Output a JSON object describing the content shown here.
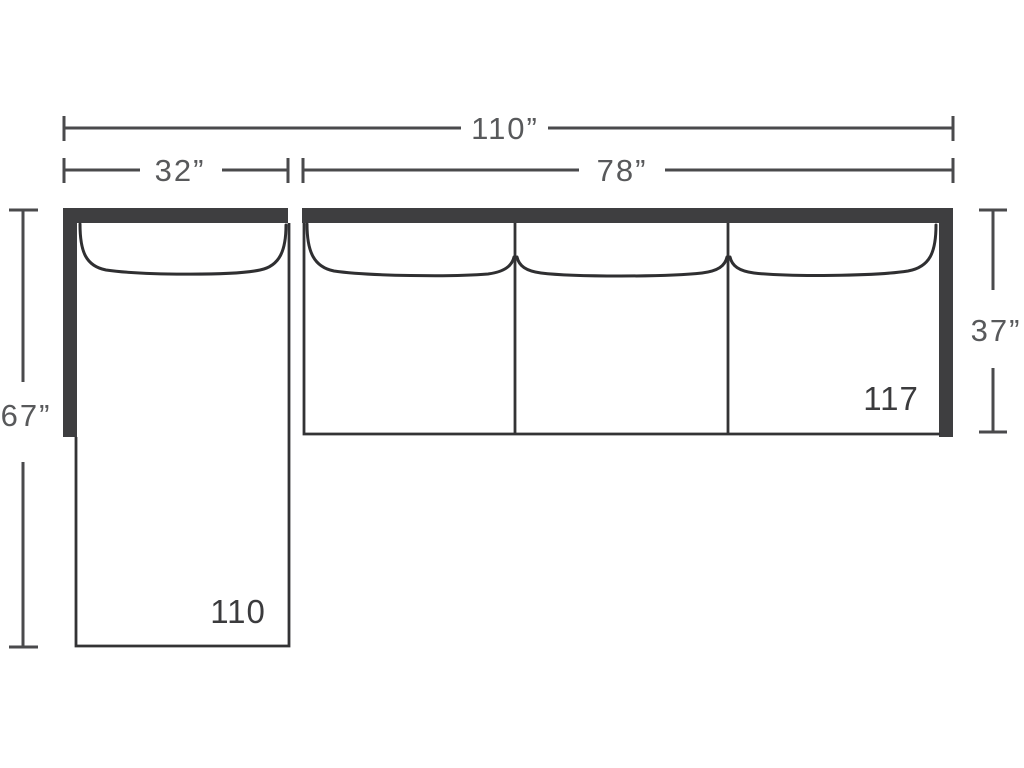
{
  "diagram": {
    "type": "sectional-sofa-top-view-dimension-diagram",
    "background": "#ffffff",
    "colors": {
      "frame_fill": "#3e3e40",
      "outline_stroke": "#333335",
      "dimension_stroke": "#4a4a4c",
      "dimension_text": "#58595b",
      "model_text": "#3b3b3d"
    },
    "dimensions": {
      "overall_width": {
        "label": "110”"
      },
      "chaise_width": {
        "label": "32”"
      },
      "sofa_width": {
        "label": "78”"
      },
      "chaise_depth": {
        "label": "67”"
      },
      "sofa_depth": {
        "label": "37”"
      }
    },
    "sections": {
      "chaise_model": {
        "label": "110"
      },
      "sofa_model": {
        "label": "117"
      }
    }
  }
}
